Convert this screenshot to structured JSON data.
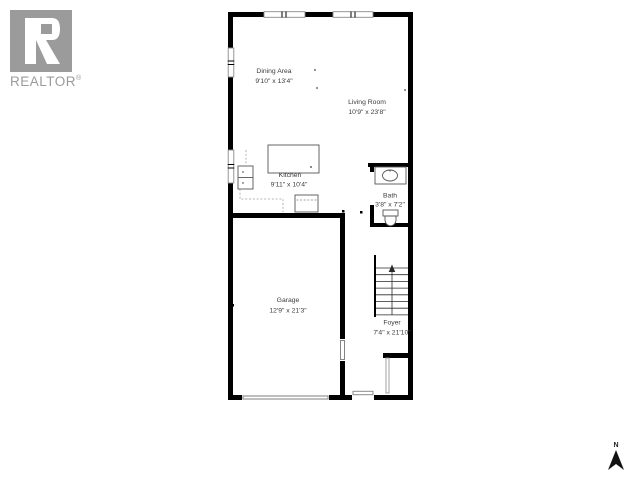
{
  "branding": {
    "logo_text": "REALTOR",
    "registered_mark": "®"
  },
  "compass": {
    "north_label": "N"
  },
  "rooms": [
    {
      "id": "dining",
      "name": "Dining Area",
      "dims": "9'10\" x 13'4\""
    },
    {
      "id": "living",
      "name": "Living Room",
      "dims": "10'9\" x 23'8\""
    },
    {
      "id": "kitchen",
      "name": "Kitchen",
      "dims": "9'11\" x 10'4\""
    },
    {
      "id": "bath",
      "name": "Bath",
      "dims": "3'8\" x 7'2\""
    },
    {
      "id": "garage",
      "name": "Garage",
      "dims": "12'9\" x 21'3\""
    },
    {
      "id": "foyer",
      "name": "Foyer",
      "dims": "7'4\" x 21'10\""
    }
  ],
  "colors": {
    "wall": "#000000",
    "fixture_outline": "#555555",
    "dashed_counter": "#a0a0a0",
    "door_gray": "#8a8a8a",
    "label_text": "#3b3b3b",
    "logo_gray": "#9b9b9b"
  }
}
